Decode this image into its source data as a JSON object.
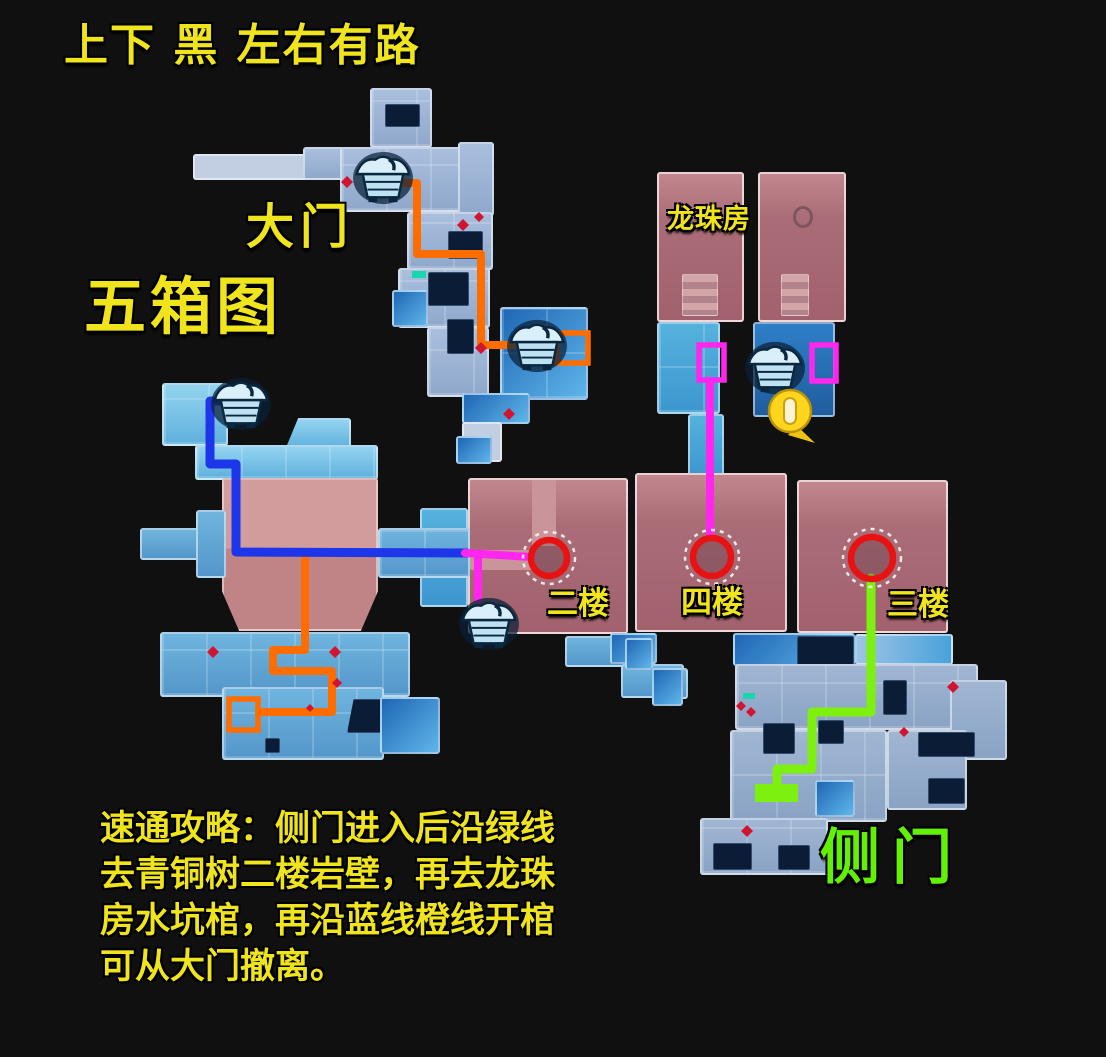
{
  "header": {
    "hint": "上下 黑 左右有路",
    "map_title": "五箱图"
  },
  "labels": {
    "main_gate": "大门",
    "dragon_ball_room": "龙珠房",
    "floor_2": "二楼",
    "floor_4": "四楼",
    "floor_3": "三楼",
    "side_door": "侧门"
  },
  "guide": {
    "lines": [
      "速通攻略：侧门进入后沿绿线",
      "去青铜树二楼岩壁，再去龙珠",
      "房水坑棺，再沿蓝线橙线开棺",
      "可从大门撤离。"
    ]
  },
  "colors": {
    "text_yellow": "#f0e41c",
    "text_green": "#62f007",
    "route_orange": "#ff6d00",
    "route_blue": "#1d36ea",
    "route_magenta": "#ff26ee",
    "route_green": "#7df010",
    "marker_red": "#e81212",
    "coin_yellow": "#ffd51d"
  },
  "icons": {
    "chest": "treasure-chest-icon",
    "coin": "coin-marker-icon",
    "entry_circle": "entry-point-circle-marker",
    "loot_rect": "loot-spot-rect-marker",
    "enemy_dot": "enemy-dot-marker"
  }
}
